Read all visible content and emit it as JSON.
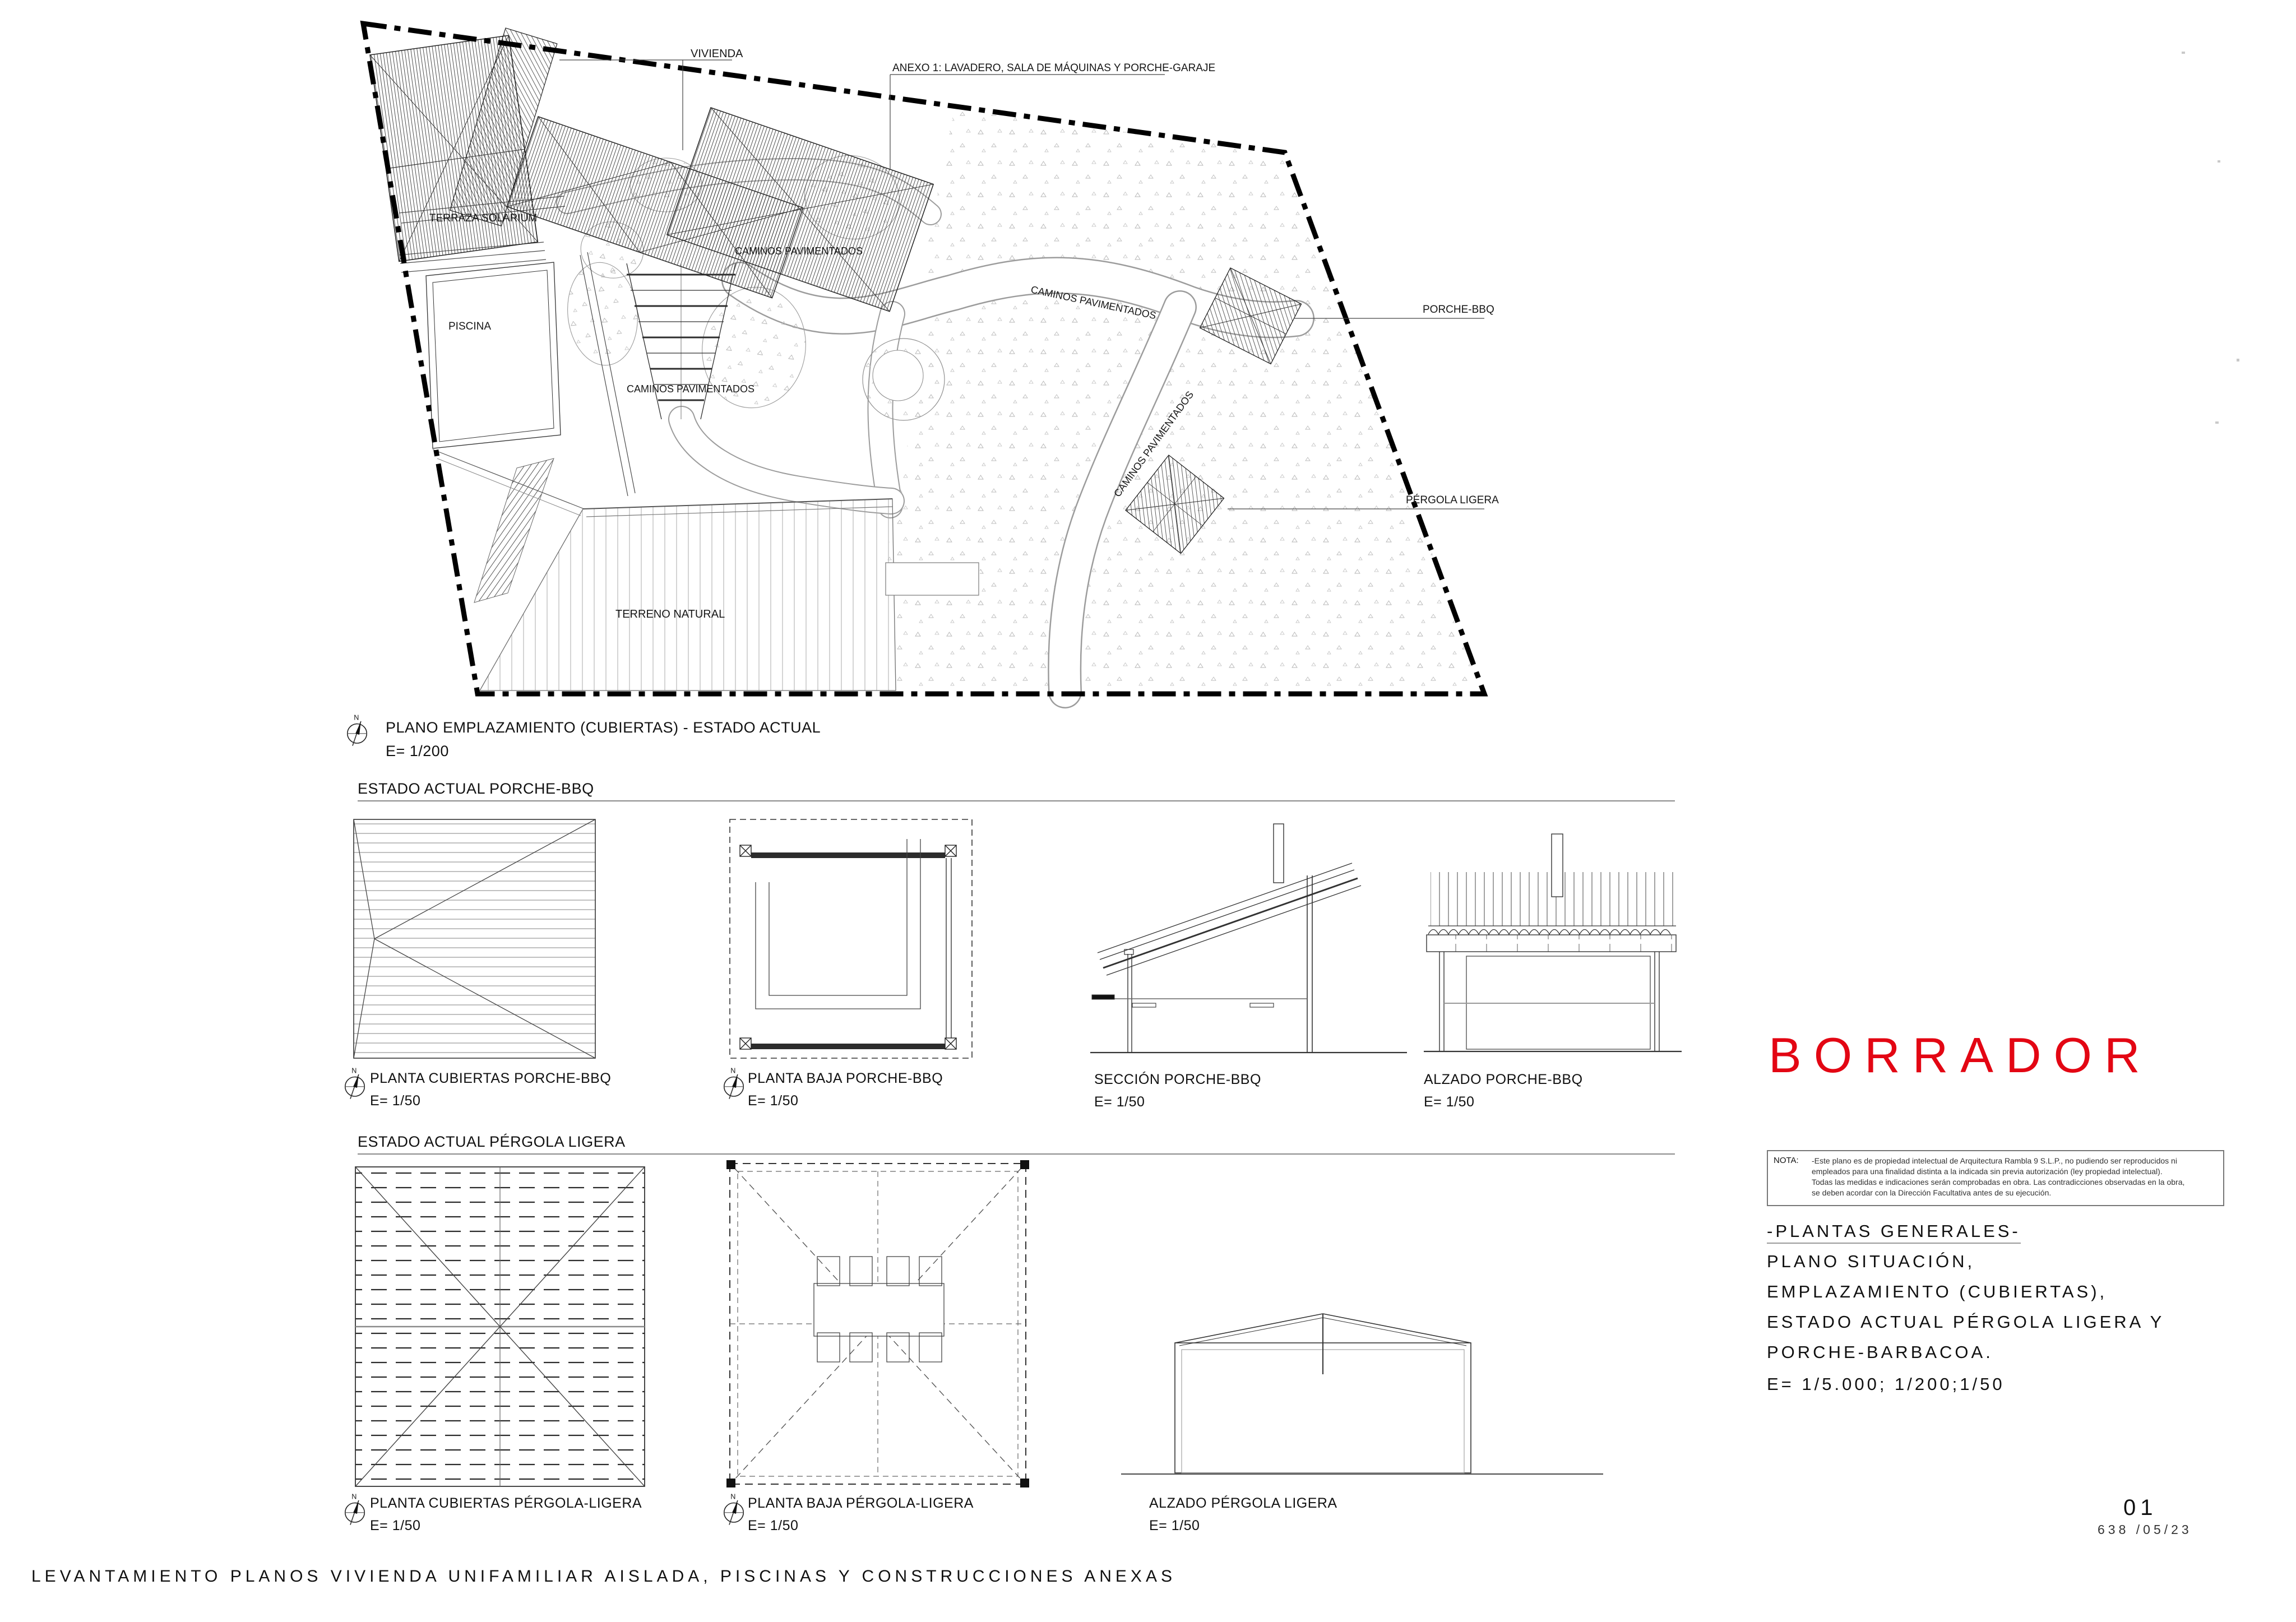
{
  "colors": {
    "accent_red": "#e30613",
    "line_dark": "#1a1a1a"
  },
  "site_plan": {
    "compass_n": "N",
    "labels": {
      "vivienda": "VIVIENDA",
      "anexo": "ANEXO 1: LAVADERO, SALA DE MÁQUINAS Y PORCHE-GARAJE",
      "terraza": "TERRAZA SOLARIUM",
      "piscina": "PISCINA",
      "caminos": "CAMINOS PAVIMENTADOS",
      "porche_bbq": "PORCHE-BBQ",
      "pergola": "PÉRGOLA LIGERA",
      "terreno": "TERRENO NATURAL"
    },
    "caption": {
      "title": "PLANO EMPLAZAMIENTO (CUBIERTAS) - ESTADO ACTUAL",
      "scale": "E= 1/200"
    }
  },
  "sections": [
    {
      "heading": "ESTADO ACTUAL PORCHE-BBQ",
      "drawings": [
        {
          "title": "PLANTA CUBIERTAS PORCHE-BBQ",
          "scale": "E= 1/50"
        },
        {
          "title": "PLANTA BAJA PORCHE-BBQ",
          "scale": "E= 1/50"
        },
        {
          "title": "SECCIÓN PORCHE-BBQ",
          "scale": "E= 1/50"
        },
        {
          "title": "ALZADO PORCHE-BBQ",
          "scale": "E= 1/50"
        }
      ]
    },
    {
      "heading": "ESTADO ACTUAL PÉRGOLA LIGERA",
      "drawings": [
        {
          "title": "PLANTA CUBIERTAS PÉRGOLA-LIGERA",
          "scale": "E= 1/50"
        },
        {
          "title": "PLANTA BAJA PÉRGOLA-LIGERA",
          "scale": "E= 1/50"
        },
        {
          "title": "ALZADO PÉRGOLA LIGERA",
          "scale": "E= 1/50"
        }
      ]
    }
  ],
  "watermark": "BORRADOR",
  "nota": {
    "label": "NOTA:",
    "lines": [
      "-Este plano es de propiedad intelectual de Arquitectura Rambla 9 S.L.P., no pudiendo ser reproducidos ni",
      "empleados para una finalidad distinta a la indicada sin previa autorización (ley propiedad intelectual).",
      "Todas las medidas e indicaciones serán comprobadas en obra. Las contradicciones observadas en la obra,",
      "se deben acordar con la Dirección Facultativa antes de su ejecución."
    ]
  },
  "title_block": {
    "lines": [
      "-PLANTAS GENERALES-",
      "PLANO SITUACIÓN,",
      "EMPLAZAMIENTO (CUBIERTAS),",
      "ESTADO ACTUAL PÉRGOLA LIGERA Y",
      "PORCHE-BARBACOA."
    ],
    "scale": "E= 1/5.000; 1/200;1/50"
  },
  "sheet": {
    "number": "01",
    "code": "638 /05/23"
  },
  "footer": "LEVANTAMIENTO PLANOS VIVIENDA UNIFAMILIAR AISLADA, PISCINAS Y CONSTRUCCIONES ANEXAS"
}
